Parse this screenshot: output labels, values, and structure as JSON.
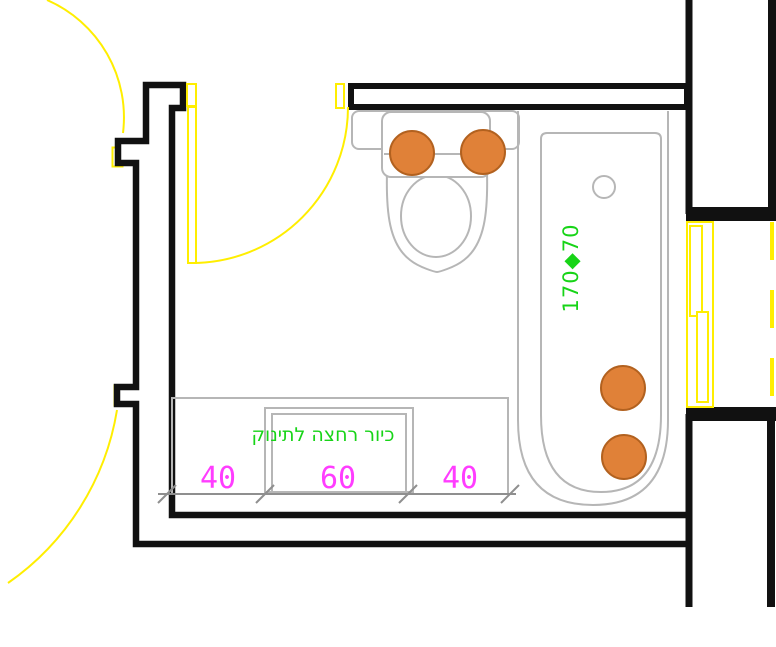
{
  "type": "architectural-floor-plan",
  "room": "bathroom",
  "labels": {
    "bathtub_size": "170◆70",
    "sink_caption": "כיור רחצה לתינוק",
    "dimensions": [
      "40",
      "60",
      "40"
    ]
  },
  "colors": {
    "wall": "#111111",
    "fixture": "#b6b6b6",
    "dimension": "#8f8f8f",
    "door": "#ffee00",
    "green": "#17d417",
    "magenta": "#ff3dff",
    "marker_fill": "#e08138",
    "marker_stroke": "#b2611f",
    "background": "#ffffff"
  },
  "markers": {
    "count": 4
  }
}
